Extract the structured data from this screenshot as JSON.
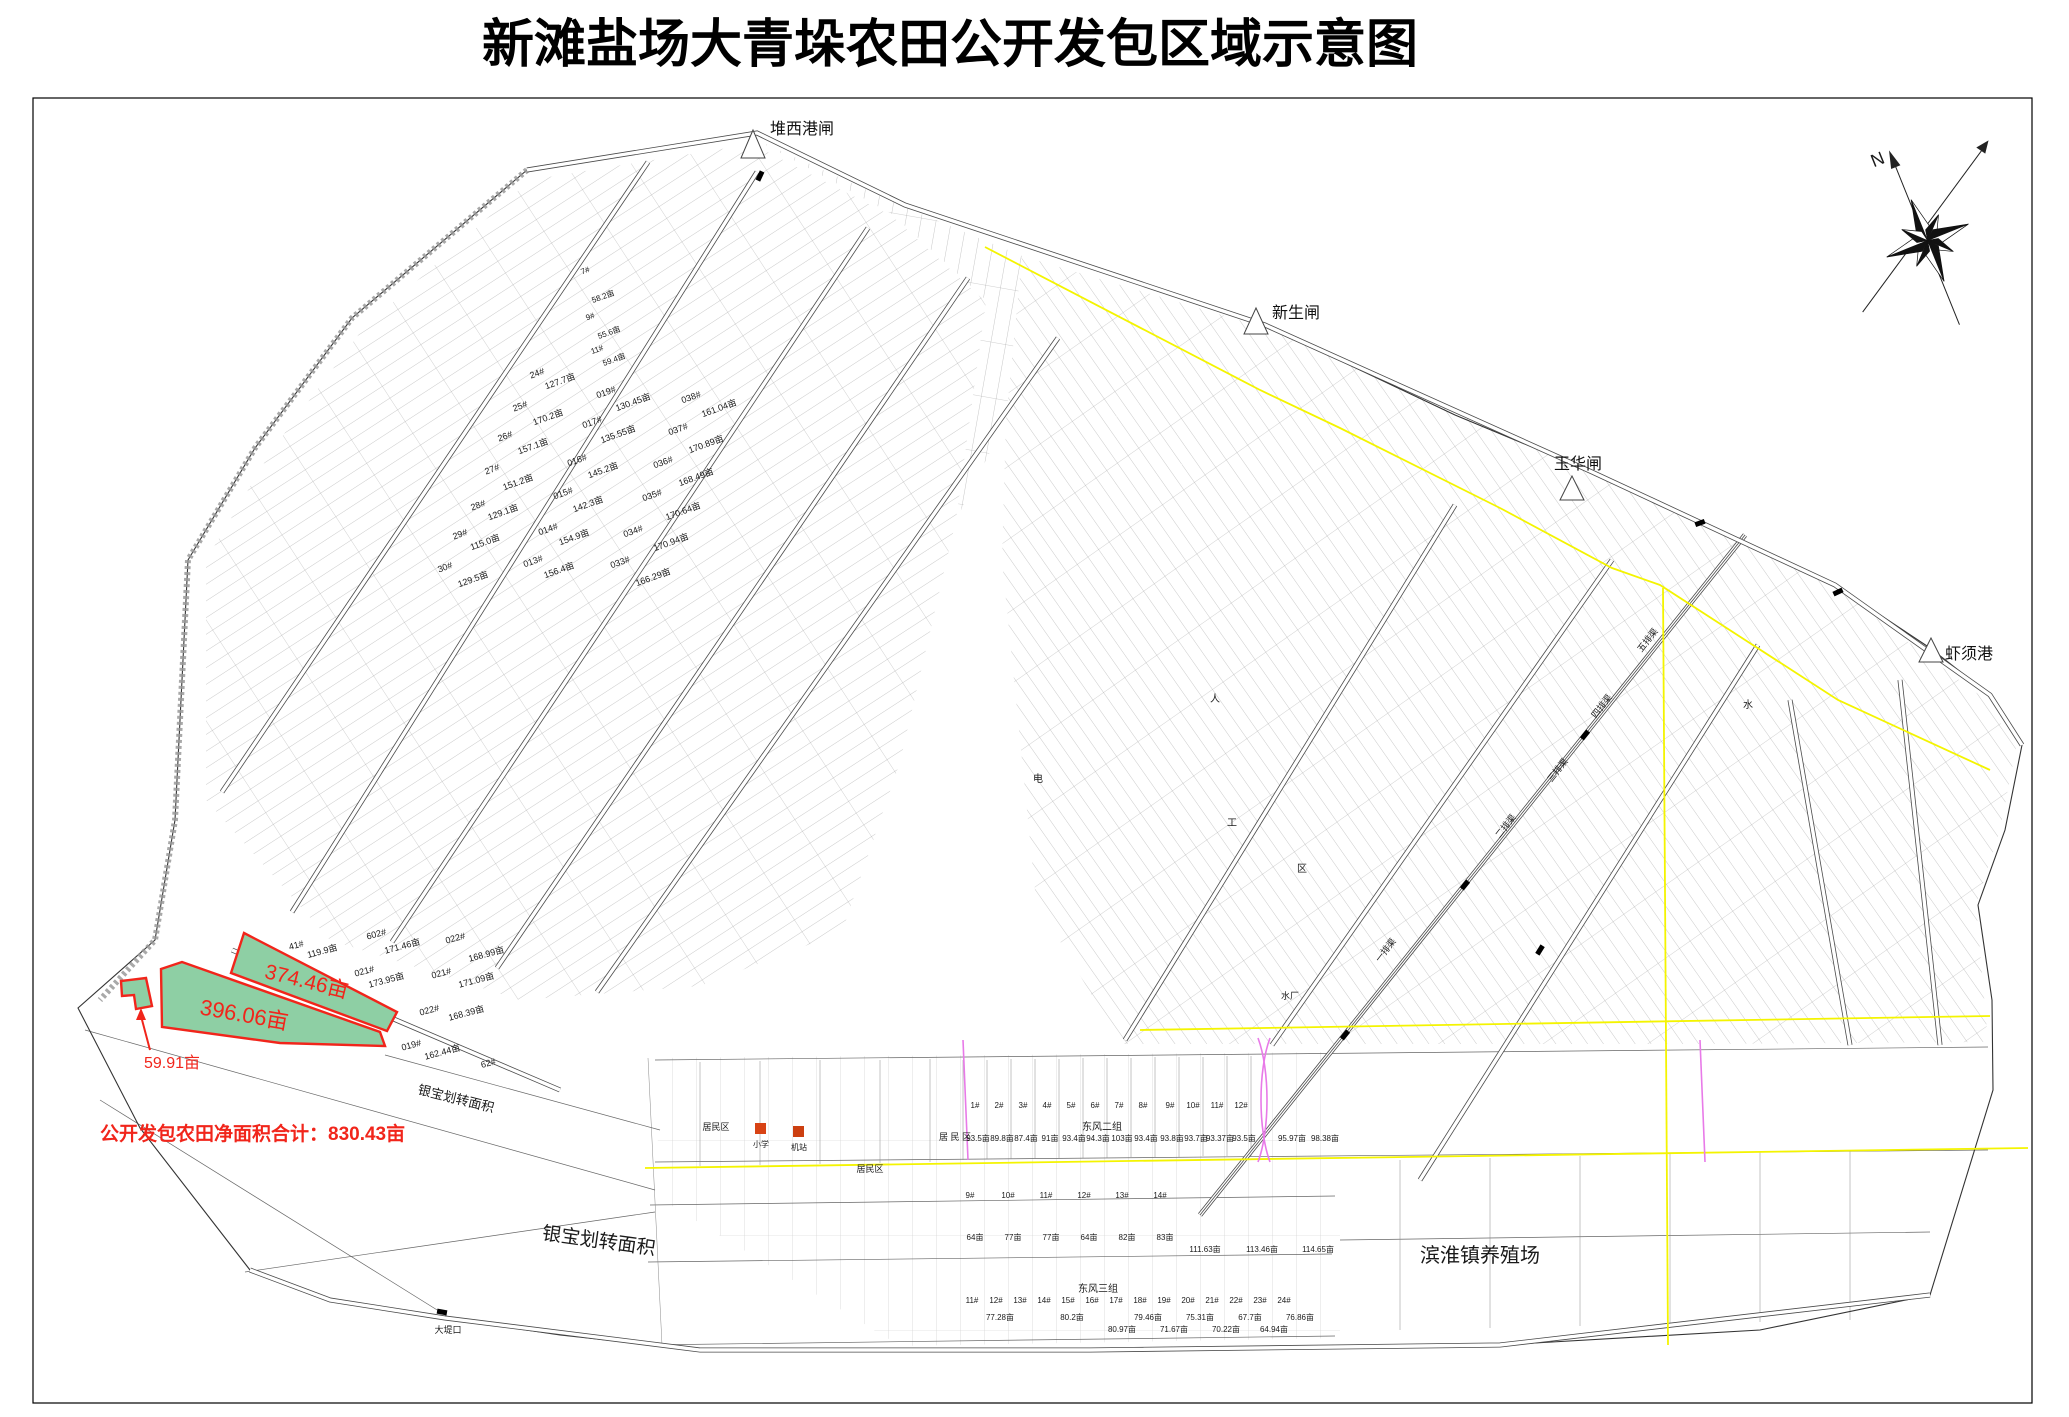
{
  "title": "新滩盐场大青垛农田公开发包区域示意图",
  "compass": {
    "north_label": "N"
  },
  "gates": [
    {
      "name": "堆西港闸",
      "x": 770,
      "y": 134
    },
    {
      "name": "新生闸",
      "x": 1272,
      "y": 318
    },
    {
      "name": "玉华闸",
      "x": 1554,
      "y": 469
    },
    {
      "name": "虾须港",
      "x": 1945,
      "y": 659
    }
  ],
  "highlight": {
    "fill": "#8ecfa4",
    "stroke": "#f1251b",
    "total_note": "公开发包农田净面积合计：830.43亩",
    "parcels": [
      {
        "area": "374.46亩"
      },
      {
        "area": "396.06亩"
      },
      {
        "area": "59.91亩"
      }
    ]
  },
  "labels": [
    {
      "t": "374.46亩",
      "x": 305,
      "y": 988,
      "s": 21,
      "r": 14,
      "c": "r"
    },
    {
      "t": "396.06亩",
      "x": 243,
      "y": 1022,
      "s": 22,
      "r": 10,
      "c": "r"
    },
    {
      "t": "59.91亩",
      "x": 172,
      "y": 1068,
      "s": 16,
      "c": "r"
    },
    {
      "t": "银宝划转面积",
      "x": 598,
      "y": 1247,
      "s": 19,
      "r": 8
    },
    {
      "t": "银宝划转面积",
      "x": 455,
      "y": 1103,
      "s": 13,
      "r": 14
    },
    {
      "t": "滨淮镇养殖场",
      "x": 1480,
      "y": 1262,
      "s": 20
    },
    {
      "t": "东风二组",
      "x": 1102,
      "y": 1130,
      "s": 10
    },
    {
      "t": "东风三组",
      "x": 1098,
      "y": 1292,
      "s": 10
    },
    {
      "t": "居民区",
      "x": 716,
      "y": 1130,
      "s": 9
    },
    {
      "t": "居 民 区",
      "x": 955,
      "y": 1140,
      "s": 9
    },
    {
      "t": "居民区",
      "x": 870,
      "y": 1172,
      "s": 9
    },
    {
      "t": "小学",
      "x": 761,
      "y": 1147,
      "s": 8
    },
    {
      "t": "机站",
      "x": 799,
      "y": 1150,
      "s": 8
    },
    {
      "t": "大堤口",
      "x": 448,
      "y": 1333,
      "s": 9
    },
    {
      "t": "水厂",
      "x": 1290,
      "y": 999,
      "s": 9
    },
    {
      "t": "一排渠",
      "x": 1388,
      "y": 952,
      "s": 9,
      "r": -52
    },
    {
      "t": "二排渠",
      "x": 1508,
      "y": 828,
      "s": 9,
      "r": -52
    },
    {
      "t": "三排渠",
      "x": 1560,
      "y": 772,
      "s": 9,
      "r": -52
    },
    {
      "t": "四排渠",
      "x": 1604,
      "y": 708,
      "s": 9,
      "r": -52
    },
    {
      "t": "五排渠",
      "x": 1650,
      "y": 642,
      "s": 9,
      "r": -52
    },
    {
      "t": "工",
      "x": 1232,
      "y": 826,
      "s": 10
    },
    {
      "t": "区",
      "x": 1302,
      "y": 872,
      "s": 10
    },
    {
      "t": "电",
      "x": 1038,
      "y": 782,
      "s": 10
    },
    {
      "t": "水",
      "x": 1748,
      "y": 708,
      "s": 10
    },
    {
      "t": "人",
      "x": 1215,
      "y": 702,
      "s": 10
    },
    {
      "t": "24#",
      "x": 538,
      "y": 376,
      "s": 9,
      "r": -20
    },
    {
      "t": "127.7亩",
      "x": 561,
      "y": 384,
      "s": 9,
      "r": -20
    },
    {
      "t": "25#",
      "x": 521,
      "y": 409,
      "s": 9,
      "r": -20
    },
    {
      "t": "170.2亩",
      "x": 549,
      "y": 420,
      "s": 9,
      "r": -20
    },
    {
      "t": "26#",
      "x": 506,
      "y": 439,
      "s": 9,
      "r": -20
    },
    {
      "t": "157.1亩",
      "x": 534,
      "y": 449,
      "s": 9,
      "r": -20
    },
    {
      "t": "27#",
      "x": 493,
      "y": 472,
      "s": 9,
      "r": -20
    },
    {
      "t": "151.2亩",
      "x": 519,
      "y": 485,
      "s": 9,
      "r": -20
    },
    {
      "t": "28#",
      "x": 479,
      "y": 508,
      "s": 9,
      "r": -20
    },
    {
      "t": "129.1亩",
      "x": 504,
      "y": 515,
      "s": 9,
      "r": -20
    },
    {
      "t": "29#",
      "x": 461,
      "y": 537,
      "s": 9,
      "r": -20
    },
    {
      "t": "115.0亩",
      "x": 486,
      "y": 545,
      "s": 9,
      "r": -20
    },
    {
      "t": "30#",
      "x": 446,
      "y": 570,
      "s": 9,
      "r": -20
    },
    {
      "t": "129.5亩",
      "x": 474,
      "y": 582,
      "s": 9,
      "r": -20
    },
    {
      "t": "7#",
      "x": 586,
      "y": 273,
      "s": 8,
      "r": -20
    },
    {
      "t": "58.2亩",
      "x": 604,
      "y": 299,
      "s": 8,
      "r": -20
    },
    {
      "t": "9#",
      "x": 591,
      "y": 319,
      "s": 8,
      "r": -20
    },
    {
      "t": "55.6亩",
      "x": 610,
      "y": 335,
      "s": 8,
      "r": -20
    },
    {
      "t": "11#",
      "x": 598,
      "y": 352,
      "s": 8,
      "r": -20
    },
    {
      "t": "59.4亩",
      "x": 615,
      "y": 362,
      "s": 8,
      "r": -20
    },
    {
      "t": "019#",
      "x": 607,
      "y": 395,
      "s": 9,
      "r": -20
    },
    {
      "t": "130.45亩",
      "x": 634,
      "y": 405,
      "s": 9,
      "r": -20
    },
    {
      "t": "017#",
      "x": 593,
      "y": 425,
      "s": 9,
      "r": -20
    },
    {
      "t": "135.55亩",
      "x": 619,
      "y": 437,
      "s": 9,
      "r": -20
    },
    {
      "t": "016#",
      "x": 578,
      "y": 463,
      "s": 9,
      "r": -20
    },
    {
      "t": "145.2亩",
      "x": 604,
      "y": 473,
      "s": 9,
      "r": -20
    },
    {
      "t": "015#",
      "x": 564,
      "y": 496,
      "s": 9,
      "r": -20
    },
    {
      "t": "142.3亩",
      "x": 589,
      "y": 507,
      "s": 9,
      "r": -20
    },
    {
      "t": "014#",
      "x": 549,
      "y": 532,
      "s": 9,
      "r": -20
    },
    {
      "t": "154.9亩",
      "x": 575,
      "y": 540,
      "s": 9,
      "r": -20
    },
    {
      "t": "013#",
      "x": 534,
      "y": 564,
      "s": 9,
      "r": -20
    },
    {
      "t": "156.4亩",
      "x": 560,
      "y": 573,
      "s": 9,
      "r": -20
    },
    {
      "t": "038#",
      "x": 692,
      "y": 400,
      "s": 9,
      "r": -20
    },
    {
      "t": "161.04亩",
      "x": 720,
      "y": 411,
      "s": 9,
      "r": -20
    },
    {
      "t": "037#",
      "x": 679,
      "y": 432,
      "s": 9,
      "r": -20
    },
    {
      "t": "170.89亩",
      "x": 707,
      "y": 447,
      "s": 9,
      "r": -20
    },
    {
      "t": "036#",
      "x": 664,
      "y": 465,
      "s": 9,
      "r": -20
    },
    {
      "t": "168.49亩",
      "x": 697,
      "y": 480,
      "s": 9,
      "r": -20
    },
    {
      "t": "035#",
      "x": 653,
      "y": 498,
      "s": 9,
      "r": -20
    },
    {
      "t": "170.64亩",
      "x": 684,
      "y": 514,
      "s": 9,
      "r": -20
    },
    {
      "t": "034#",
      "x": 634,
      "y": 534,
      "s": 9,
      "r": -20
    },
    {
      "t": "170.94亩",
      "x": 672,
      "y": 545,
      "s": 9,
      "r": -20
    },
    {
      "t": "033#",
      "x": 621,
      "y": 565,
      "s": 9,
      "r": -20
    },
    {
      "t": "166.29亩",
      "x": 654,
      "y": 580,
      "s": 9,
      "r": -20
    },
    {
      "t": "41#",
      "x": 297,
      "y": 948,
      "s": 9,
      "r": -15
    },
    {
      "t": "119.9亩",
      "x": 323,
      "y": 954,
      "s": 9,
      "r": -15
    },
    {
      "t": "602#",
      "x": 377,
      "y": 937,
      "s": 9,
      "r": -15
    },
    {
      "t": "171.46亩",
      "x": 403,
      "y": 949,
      "s": 9,
      "r": -15
    },
    {
      "t": "022#",
      "x": 456,
      "y": 941,
      "s": 9,
      "r": -15
    },
    {
      "t": "168.99亩",
      "x": 487,
      "y": 957,
      "s": 9,
      "r": -15
    },
    {
      "t": "021#",
      "x": 365,
      "y": 974,
      "s": 9,
      "r": -15
    },
    {
      "t": "173.95亩",
      "x": 387,
      "y": 983,
      "s": 9,
      "r": -15
    },
    {
      "t": "021#",
      "x": 442,
      "y": 976,
      "s": 9,
      "r": -15
    },
    {
      "t": "171.09亩",
      "x": 477,
      "y": 983,
      "s": 9,
      "r": -15
    },
    {
      "t": "022#",
      "x": 430,
      "y": 1013,
      "s": 9,
      "r": -15
    },
    {
      "t": "168.39亩",
      "x": 467,
      "y": 1016,
      "s": 9,
      "r": -15
    },
    {
      "t": "019#",
      "x": 412,
      "y": 1048,
      "s": 9,
      "r": -15
    },
    {
      "t": "162.44亩",
      "x": 443,
      "y": 1055,
      "s": 9,
      "r": -15
    },
    {
      "t": "62#",
      "x": 489,
      "y": 1066,
      "s": 9,
      "r": -15
    },
    {
      "t": "1#",
      "x": 975,
      "y": 1108,
      "s": 8
    },
    {
      "t": "2#",
      "x": 999,
      "y": 1108,
      "s": 8
    },
    {
      "t": "3#",
      "x": 1023,
      "y": 1108,
      "s": 8
    },
    {
      "t": "4#",
      "x": 1047,
      "y": 1108,
      "s": 8
    },
    {
      "t": "5#",
      "x": 1071,
      "y": 1108,
      "s": 8
    },
    {
      "t": "6#",
      "x": 1095,
      "y": 1108,
      "s": 8
    },
    {
      "t": "7#",
      "x": 1119,
      "y": 1108,
      "s": 8
    },
    {
      "t": "8#",
      "x": 1143,
      "y": 1108,
      "s": 8
    },
    {
      "t": "9#",
      "x": 1170,
      "y": 1108,
      "s": 8
    },
    {
      "t": "10#",
      "x": 1193,
      "y": 1108,
      "s": 8
    },
    {
      "t": "11#",
      "x": 1217,
      "y": 1108,
      "s": 8
    },
    {
      "t": "12#",
      "x": 1241,
      "y": 1108,
      "s": 8
    },
    {
      "t": "93.5亩",
      "x": 978,
      "y": 1141,
      "s": 8
    },
    {
      "t": "89.8亩",
      "x": 1002,
      "y": 1141,
      "s": 8
    },
    {
      "t": "87.4亩",
      "x": 1026,
      "y": 1141,
      "s": 8
    },
    {
      "t": "91亩",
      "x": 1050,
      "y": 1141,
      "s": 8
    },
    {
      "t": "93.4亩",
      "x": 1074,
      "y": 1141,
      "s": 8
    },
    {
      "t": "94.3亩",
      "x": 1098,
      "y": 1141,
      "s": 8
    },
    {
      "t": "103亩",
      "x": 1122,
      "y": 1141,
      "s": 8
    },
    {
      "t": "93.4亩",
      "x": 1146,
      "y": 1141,
      "s": 8
    },
    {
      "t": "93.8亩",
      "x": 1172,
      "y": 1141,
      "s": 8
    },
    {
      "t": "93.7亩",
      "x": 1196,
      "y": 1141,
      "s": 8
    },
    {
      "t": "93.37亩",
      "x": 1220,
      "y": 1141,
      "s": 8
    },
    {
      "t": "93.5亩",
      "x": 1244,
      "y": 1141,
      "s": 8
    },
    {
      "t": "95.97亩",
      "x": 1292,
      "y": 1141,
      "s": 8
    },
    {
      "t": "98.38亩",
      "x": 1325,
      "y": 1141,
      "s": 8
    },
    {
      "t": "9#",
      "x": 970,
      "y": 1198,
      "s": 8
    },
    {
      "t": "10#",
      "x": 1008,
      "y": 1198,
      "s": 8
    },
    {
      "t": "11#",
      "x": 1046,
      "y": 1198,
      "s": 8
    },
    {
      "t": "12#",
      "x": 1084,
      "y": 1198,
      "s": 8
    },
    {
      "t": "13#",
      "x": 1122,
      "y": 1198,
      "s": 8
    },
    {
      "t": "14#",
      "x": 1160,
      "y": 1198,
      "s": 8
    },
    {
      "t": "64亩",
      "x": 975,
      "y": 1240,
      "s": 8
    },
    {
      "t": "77亩",
      "x": 1013,
      "y": 1240,
      "s": 8
    },
    {
      "t": "77亩",
      "x": 1051,
      "y": 1240,
      "s": 8
    },
    {
      "t": "64亩",
      "x": 1089,
      "y": 1240,
      "s": 8
    },
    {
      "t": "82亩",
      "x": 1127,
      "y": 1240,
      "s": 8
    },
    {
      "t": "83亩",
      "x": 1165,
      "y": 1240,
      "s": 8
    },
    {
      "t": "111.63亩",
      "x": 1205,
      "y": 1252,
      "s": 8
    },
    {
      "t": "113.46亩",
      "x": 1262,
      "y": 1252,
      "s": 8
    },
    {
      "t": "114.65亩",
      "x": 1318,
      "y": 1252,
      "s": 8
    },
    {
      "t": "11#",
      "x": 972,
      "y": 1303,
      "s": 8
    },
    {
      "t": "12#",
      "x": 996,
      "y": 1303,
      "s": 8
    },
    {
      "t": "13#",
      "x": 1020,
      "y": 1303,
      "s": 8
    },
    {
      "t": "14#",
      "x": 1044,
      "y": 1303,
      "s": 8
    },
    {
      "t": "15#",
      "x": 1068,
      "y": 1303,
      "s": 8
    },
    {
      "t": "16#",
      "x": 1092,
      "y": 1303,
      "s": 8
    },
    {
      "t": "17#",
      "x": 1116,
      "y": 1303,
      "s": 8
    },
    {
      "t": "18#",
      "x": 1140,
      "y": 1303,
      "s": 8
    },
    {
      "t": "19#",
      "x": 1164,
      "y": 1303,
      "s": 8
    },
    {
      "t": "20#",
      "x": 1188,
      "y": 1303,
      "s": 8
    },
    {
      "t": "21#",
      "x": 1212,
      "y": 1303,
      "s": 8
    },
    {
      "t": "22#",
      "x": 1236,
      "y": 1303,
      "s": 8
    },
    {
      "t": "23#",
      "x": 1260,
      "y": 1303,
      "s": 8
    },
    {
      "t": "24#",
      "x": 1284,
      "y": 1303,
      "s": 8
    },
    {
      "t": "77.28亩",
      "x": 1000,
      "y": 1320,
      "s": 8
    },
    {
      "t": "80.2亩",
      "x": 1072,
      "y": 1320,
      "s": 8
    },
    {
      "t": "80.97亩",
      "x": 1122,
      "y": 1332,
      "s": 8
    },
    {
      "t": "79.46亩",
      "x": 1148,
      "y": 1320,
      "s": 8
    },
    {
      "t": "71.67亩",
      "x": 1174,
      "y": 1332,
      "s": 8
    },
    {
      "t": "75.31亩",
      "x": 1200,
      "y": 1320,
      "s": 8
    },
    {
      "t": "70.22亩",
      "x": 1226,
      "y": 1332,
      "s": 8
    },
    {
      "t": "67.7亩",
      "x": 1250,
      "y": 1320,
      "s": 8
    },
    {
      "t": "64.94亩",
      "x": 1274,
      "y": 1332,
      "s": 8
    },
    {
      "t": "76.86亩",
      "x": 1300,
      "y": 1320,
      "s": 8
    }
  ]
}
